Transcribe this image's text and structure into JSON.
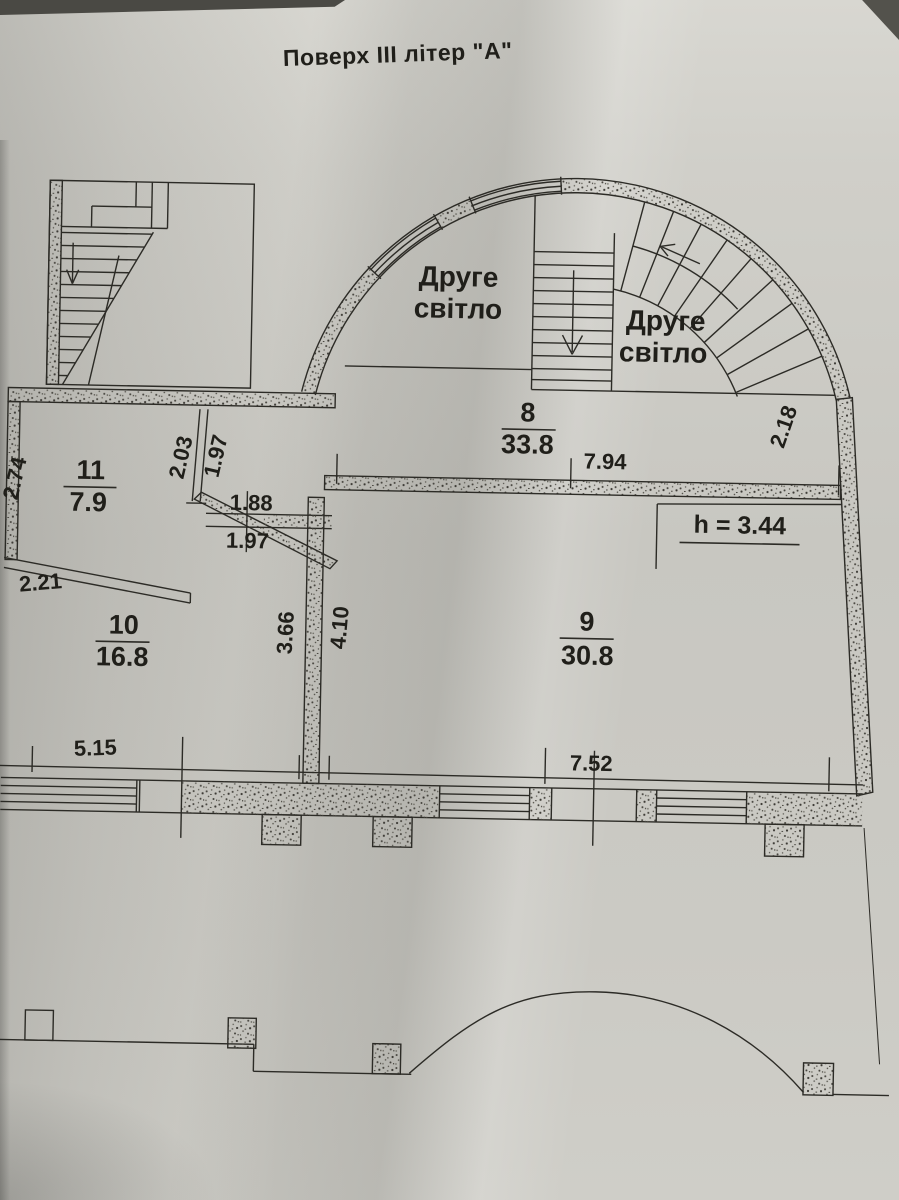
{
  "page": {
    "title": "Поверх III літер \"А\""
  },
  "plan": {
    "second_light_left": {
      "line1": "Друге",
      "line2": "світло"
    },
    "second_light_right": {
      "line1": "Друге",
      "line2": "світло"
    },
    "rooms": {
      "room8": {
        "number": "8",
        "area": "33.8"
      },
      "room9": {
        "number": "9",
        "area": "30.8"
      },
      "room10": {
        "number": "10",
        "area": "16.8"
      },
      "room11": {
        "number": "11",
        "area": "7.9"
      }
    },
    "height_note": "h = 3.44",
    "dims": {
      "d794": "7.94",
      "d218": "2.18",
      "d274": "2.74",
      "d203": "2.03",
      "d197a": "1.97",
      "d188": "1.88",
      "d197b": "1.97",
      "d221": "2.21",
      "d366": "3.66",
      "d410": "4.10",
      "d515": "5.15",
      "d752": "7.52"
    }
  },
  "colors": {
    "paper": "#cbcac4",
    "ink": "#2c2b26"
  }
}
